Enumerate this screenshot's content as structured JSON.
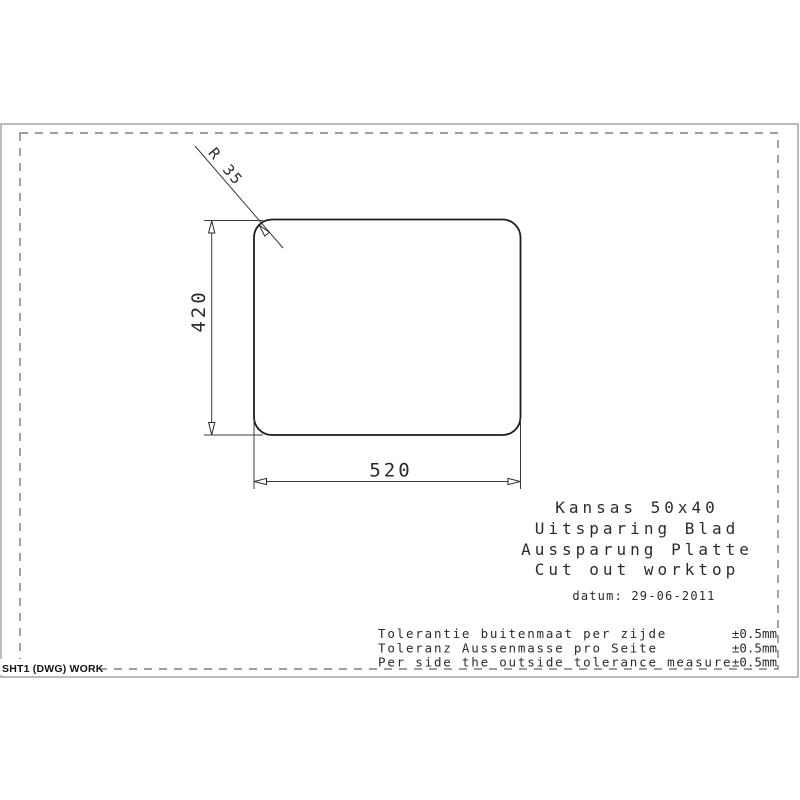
{
  "drawing": {
    "radius_label": "R 35",
    "height_dim": "420",
    "width_dim": "520"
  },
  "title_block": {
    "lines": [
      "Kansas 50x40",
      "Uitsparing Blad",
      "Aussparung Platte",
      "Cut out worktop"
    ],
    "date": "datum: 29-06-2011"
  },
  "tolerances": {
    "rows": [
      {
        "label": "Tolerantie buitenmaat per zijde",
        "value": "±0.5mm"
      },
      {
        "label": "Toleranz Aussenmasse pro Seite",
        "value": "±0.5mm"
      },
      {
        "label": "Per side the outside tolerance measure",
        "value": "±0.5mm"
      }
    ]
  },
  "footer": {
    "sheet_label": "SHT1 (DWG) WORK"
  },
  "colors": {
    "drawing_line": "#1c1c1c",
    "dim_line": "#3a3a3a",
    "frame_dash": "#7e7e7e",
    "sheet_border": "#8f8f8f",
    "text": "#2b2b2b",
    "background": "#ffffff"
  }
}
